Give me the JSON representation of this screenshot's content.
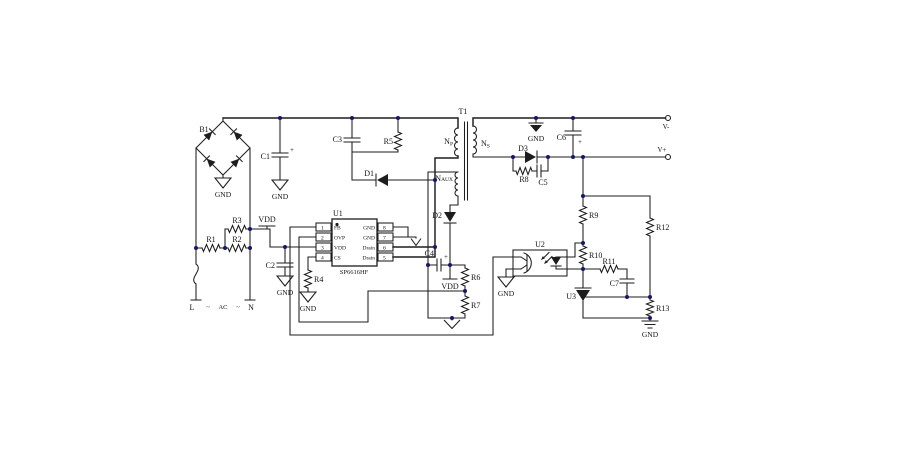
{
  "colors": {
    "wire": "#1d1d1d",
    "dot": "#16166b",
    "chip_fill": "#fbfbfb"
  },
  "labels": {
    "b1": "B1",
    "c1": "C1",
    "c2": "C2",
    "c3": "C3",
    "c4": "C4",
    "c5": "C5",
    "c6": "C6",
    "c7": "C7",
    "r1": "R1",
    "r2": "R2",
    "r3": "R3",
    "r4": "R4",
    "r5": "R5",
    "r6": "R6",
    "r7": "R7",
    "r8": "R8",
    "r9": "R9",
    "r10": "R10",
    "r11": "R11",
    "r12": "R12",
    "r13": "R13",
    "d1": "D1",
    "d2": "D2",
    "d3": "D3",
    "u2": "U2",
    "u3": "U3",
    "plus": "+"
  },
  "power": {
    "vdd": "VDD",
    "gnd": "GND"
  },
  "ac": {
    "l": "L",
    "label": "AC",
    "n": "N",
    "tilde": "~"
  },
  "terminals": {
    "vminus": "V-",
    "vplus": "V+"
  },
  "chip": {
    "ref": "U1",
    "part": "SP6616HF",
    "left_pins": [
      {
        "num": "1",
        "name": "FB"
      },
      {
        "num": "2",
        "name": "OVP"
      },
      {
        "num": "3",
        "name": "VDD"
      },
      {
        "num": "4",
        "name": "CS"
      }
    ],
    "right_pins": [
      {
        "num": "8",
        "name": "GND"
      },
      {
        "num": "7",
        "name": "GND"
      },
      {
        "num": "6",
        "name": "Drain"
      },
      {
        "num": "5",
        "name": "Drain"
      }
    ]
  },
  "transformer": {
    "ref": "T1",
    "np_main": "N",
    "np_sub": "P",
    "ns_main": "N",
    "ns_sub": "S",
    "naux_main": "N",
    "naux_sub": "AUX"
  }
}
